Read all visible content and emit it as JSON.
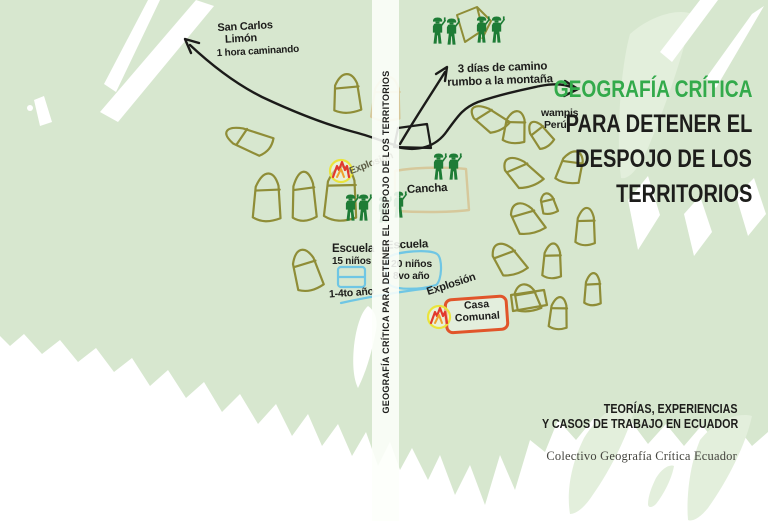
{
  "cover": {
    "title_line1": "GEOGRAFÍA CRÍTICA",
    "title_line2": "PARA DETENER EL",
    "title_line3": "DESPOJO DE LOS",
    "title_line4": "TERRITORIOS",
    "subtitle_line1": "TEORÍAS, EXPERIENCIAS",
    "subtitle_line2": "Y CASOS DE TRABAJO EN ECUADOR",
    "credit": "Colectivo Geografía Crítica Ecuador"
  },
  "spine": {
    "text": "GEOGRAFÍA CRÍTICA PARA DETENER EL DESPOJO DE LOS TERRITORIOS"
  },
  "map": {
    "labels": {
      "san_carlos_line1": "San Carlos",
      "san_carlos_line2": "Limón",
      "san_carlos_line3": "1 hora caminando",
      "camino_line1": "3 días de camino",
      "camino_line2": "rumbo a la montaña",
      "wampis_line1": "wampis",
      "wampis_line2": "Perú",
      "cancha": "Cancha",
      "explosion_left": "Explosión",
      "explosion_right": "Explosión",
      "escuela_left_name": "Escuela",
      "escuela_left_detail1": "15 niños",
      "escuela_left_detail2": "1-4to año",
      "escuela_right_name": "Escuela",
      "escuela_right_detail1": "20 niños",
      "escuela_right_detail2": "8vo año",
      "casa_comunal_line1": "Casa",
      "casa_comunal_line2": "Comunal"
    },
    "icons": {
      "soldier": "toy-soldier-figure",
      "tent": "hand-drawn-house-tent",
      "flame": "explosion-flame-burst",
      "trail": "walking-path-arrow"
    },
    "colors": {
      "background_green": "#d7e7cf",
      "leaf_green_light": "#e3efdc",
      "house_olive": "#8f8d37",
      "tan": "#d6c89b",
      "soldier_green": "#1e7c36",
      "title_green": "#33aa4b",
      "ink": "#1b1b19",
      "school_blue": "#6fc6e4",
      "casa_orange": "#e1552a",
      "flame_yellow": "#eae43c",
      "flame_red": "#e23a2e",
      "flame_orange": "#f0a22e"
    }
  }
}
